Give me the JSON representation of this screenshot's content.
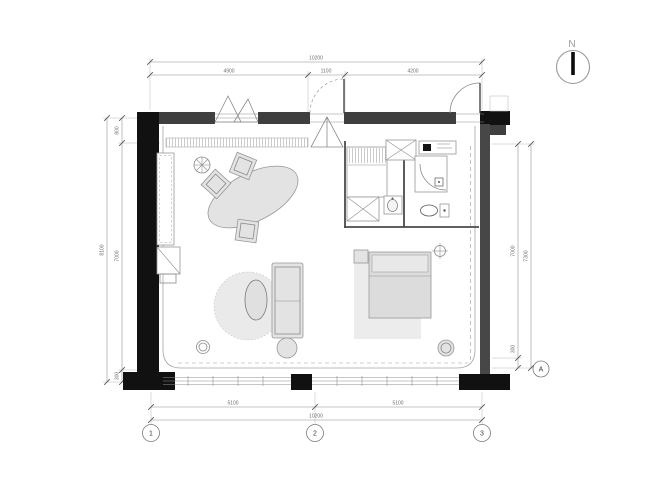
{
  "north": {
    "label": "N"
  },
  "grid": {
    "columns": [
      {
        "label": "1"
      },
      {
        "label": "2"
      },
      {
        "label": "3"
      }
    ],
    "rows": [
      {
        "label": "A"
      }
    ]
  },
  "dimensions": {
    "top": {
      "overall": "10200",
      "seg1": "4900",
      "seg2": "1100",
      "seg3": "4200"
    },
    "bottom": {
      "overall": "10200",
      "seg1": "5100",
      "seg2": "5100"
    },
    "left": {
      "overall": "8100",
      "seg_top": "800",
      "seg_mid": "7000",
      "seg_bottom": "300"
    },
    "right": {
      "inner": "7000",
      "outer": "7300",
      "bottom": "300"
    }
  },
  "colors": {
    "wall_band": "#3f3f3f",
    "pier": "#111111",
    "furniture_fill": "#e3e3e3",
    "rug_fill": "#eaeaea",
    "line": "#8a8a8a",
    "dimension_text": "#6e6e6e"
  }
}
